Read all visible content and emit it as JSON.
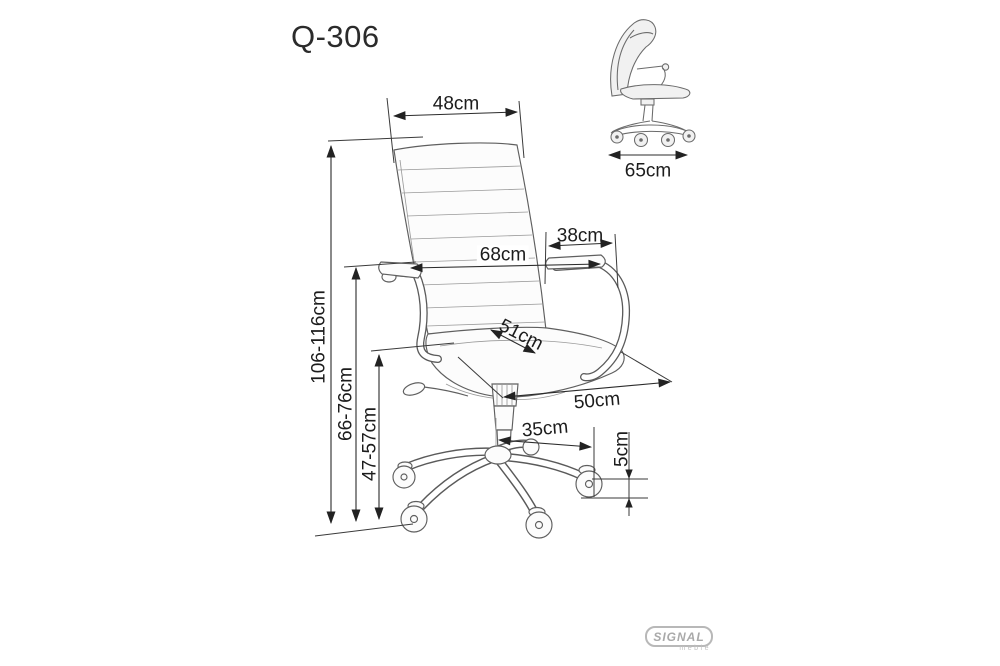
{
  "title": "Q-306",
  "logo": {
    "brand": "SIGNAL",
    "sub": "meble"
  },
  "dimensions": {
    "backrest_width": "48cm",
    "armrest_length": "38cm",
    "overall_width": "68cm",
    "seat_width_diagonal": "51cm",
    "seat_depth": "50cm",
    "base_radius": "35cm",
    "caster_height": "5cm",
    "total_height": "106-116cm",
    "armrest_height": "66-76cm",
    "seat_height": "47-57cm",
    "side_depth": "65cm"
  },
  "colors": {
    "background": "#ffffff",
    "drawing_line": "#5f5f5f",
    "dimension_line": "#2b2b2b",
    "text": "#1c1c1c",
    "logo_gray": "#a9a9a9"
  }
}
